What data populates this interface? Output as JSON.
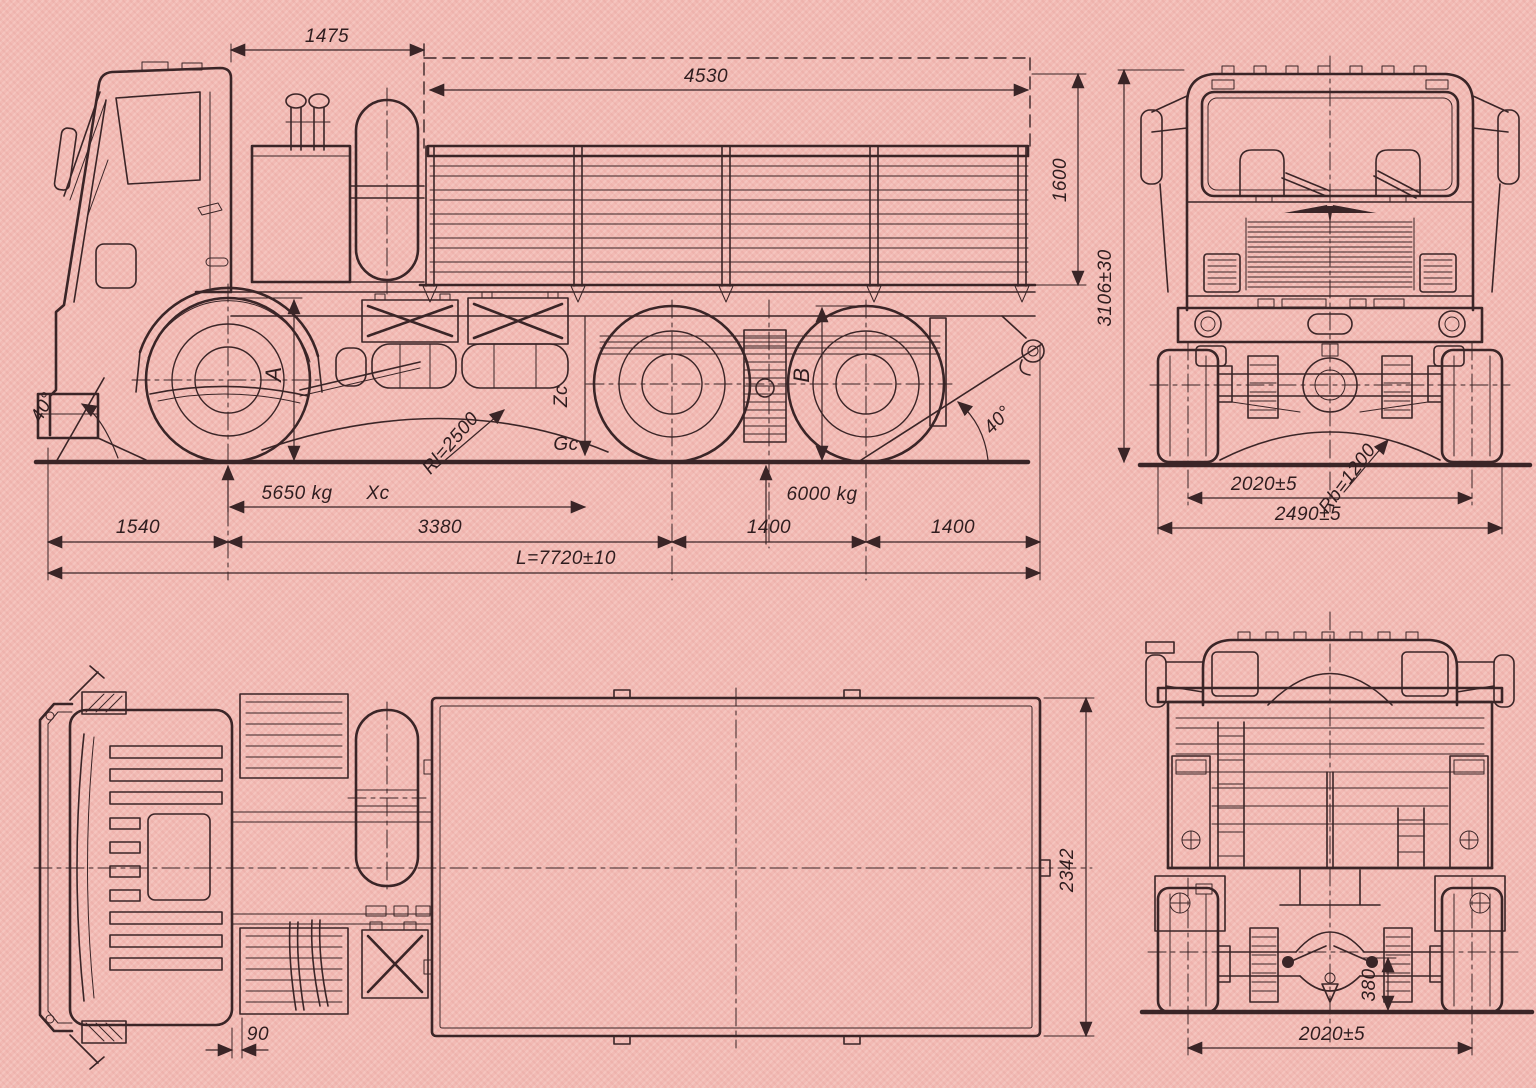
{
  "page": {
    "background": "#f2bab4",
    "ink": "#3a2527",
    "kind": "truck blueprint sheet"
  },
  "side_view": {
    "cab_back_to_bed": "1475",
    "bed_length": "4530",
    "bed_height": "1600",
    "approach_angle": "40°",
    "front_tire_marker": "A",
    "ramp_radius": "Rl=2500",
    "cg_height_marker": "Zc",
    "cg_marker": "Gc",
    "front_axle_load": "5650 kg",
    "cg_distance_marker": "Xc",
    "rear_tire_marker": "B",
    "bogie_load": "6000 kg",
    "departure_angle": "40°",
    "front_overhang": "1540",
    "wheelbase": "3380",
    "bogie_spacing": "1400",
    "rear_overhang": "1400",
    "overall_length": "L=7720±10"
  },
  "front_view": {
    "overall_height": "3106±30",
    "track_width": "2020±5",
    "clearance_radius": "Rb=1200",
    "overall_width": "2490±5"
  },
  "top_view": {
    "body_width": "2342",
    "cab_gap": "90"
  },
  "rear_view": {
    "ground_clearance": "380",
    "track_width": "2020±5"
  }
}
